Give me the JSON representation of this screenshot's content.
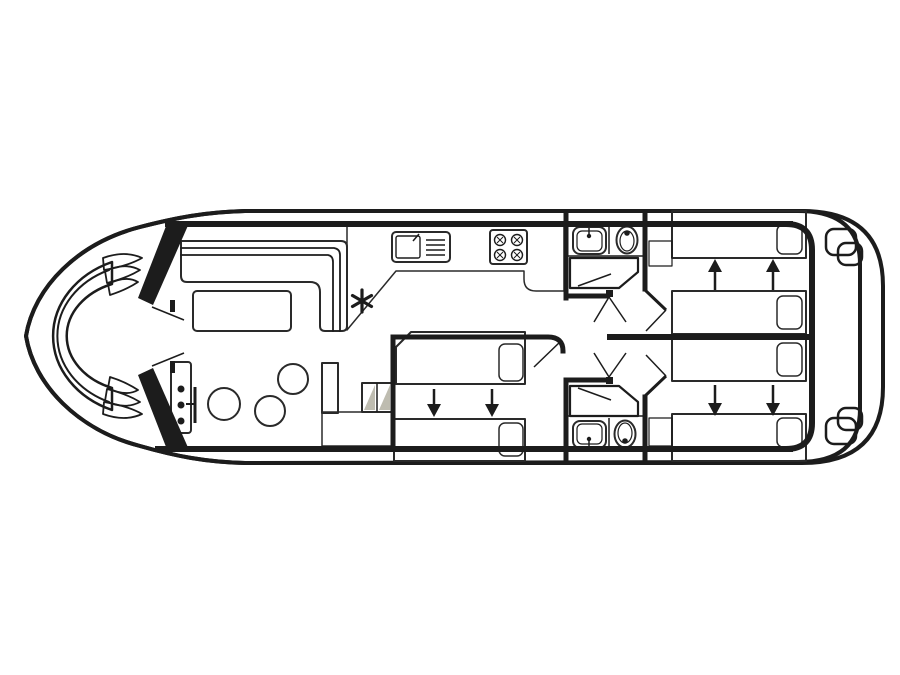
{
  "plan": {
    "title": "boat-deck-floor-plan",
    "view": "top-down",
    "areas": [
      "bow-deck",
      "bow-bench",
      "saloon",
      "helm",
      "dinette",
      "galley",
      "mid-cabin",
      "forward-bathroom",
      "corridor",
      "aft-bathroom",
      "aft-cabin-top",
      "aft-cabin-bottom",
      "stern-deck"
    ],
    "bed_count": 6,
    "bathroom_count": 2,
    "stool_count": 3,
    "symbols": {
      "heater-symbol": "six-spoke asterisk",
      "slide-arrow-icon": "solid arrow, beds slide together",
      "shower-icon": "hatched grid pentagon",
      "stove-icon": "four burner circles with cross marks",
      "sink-icon": "basin with drainer lines",
      "toilet-icon": "oval bowl with dot",
      "washbasin-icon": "rounded square with tap dot",
      "stairs-icon": "paired squares with diagonal shading",
      "door-swing-icon": "thin diagonal line with hinge square"
    }
  },
  "colors": {
    "hull_white": "#ffffff",
    "deck_cream": "#ebe6d1",
    "outline_black": "#1c1c1c",
    "sofa_teal": "#7ec8b2",
    "bed_orange": "#e6933e",
    "pillow_orange": "#f3b76c",
    "stool_pink": "#e9cdd9",
    "counter_gray": "#d6d3c6",
    "table_gray": "#d6d3c6",
    "console_gray": "#d4d1c6",
    "steps_gray": "#c9c7d2",
    "cabinet_gray": "#ccc9bc",
    "stairs_shade": "#bebcb0",
    "stairs_face": "#f4f1e4"
  }
}
